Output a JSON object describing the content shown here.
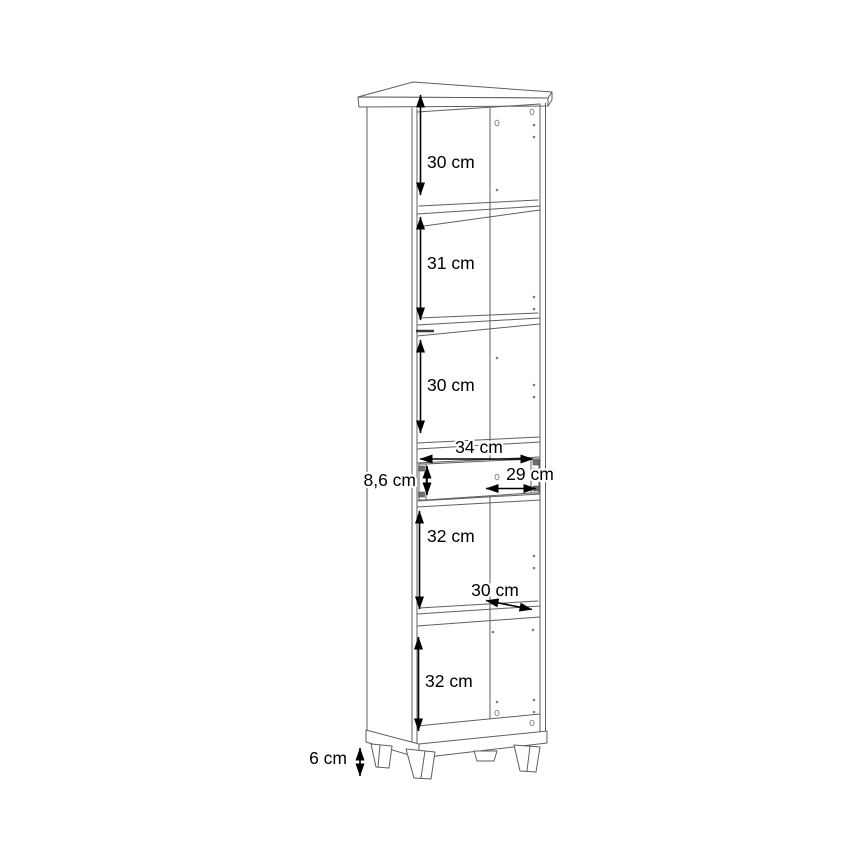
{
  "page": {
    "background": "#ffffff"
  },
  "colors": {
    "structure_line": "#5f5f5f",
    "dimension": "#000000",
    "background": "#ffffff"
  },
  "diagram": {
    "type": "furniture dimension drawing",
    "subject": "tall narrow cabinet with open shelf compartments, one drawer and four feet",
    "dimensions": {
      "section_1_height": "30 cm",
      "section_2_height": "31 cm",
      "section_3_height": "30 cm",
      "drawer_width": "34 cm",
      "drawer_front_height": "8,6 cm",
      "drawer_inner_width": "29 cm",
      "section_4_height": "32 cm",
      "shelf_depth": "30 cm",
      "section_5_height": "32 cm",
      "feet_height": "6 cm"
    }
  }
}
